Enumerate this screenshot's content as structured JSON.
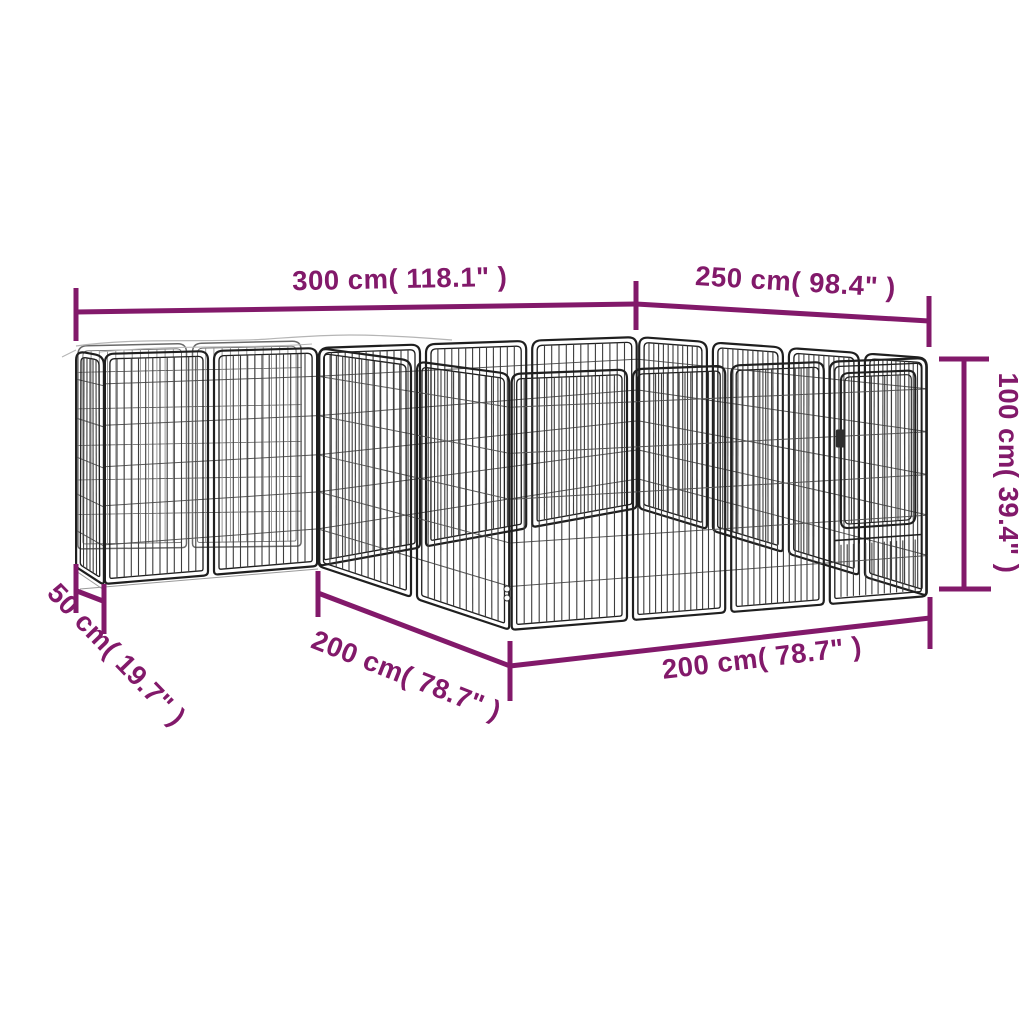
{
  "image_type": "product-dimension-diagram",
  "subject": "dog-playpen-wireframe-drawing",
  "colors": {
    "background": "#ffffff",
    "dimension_annotation": "#82196a",
    "pen_frame_dark": "#1f1f1f",
    "pen_frame_mid": "#2e2e2e",
    "pen_bar_near": "#3d3d3d",
    "pen_bar_far": "#8b8b8b",
    "pen_wire": "#5a5a5a",
    "pen_accent_light": "#b5b5b5"
  },
  "dimensions": {
    "top_left": {
      "label": "300 cm( 118.1\" )",
      "value_cm": 300,
      "value_in": 118.1
    },
    "top_right": {
      "label": "250 cm( 98.4\" )",
      "value_cm": 250,
      "value_in": 98.4
    },
    "right_height": {
      "label": "100 cm( 39.4\" )",
      "value_cm": 100,
      "value_in": 39.4
    },
    "left_depth": {
      "label": "50 cm( 19.7\" )",
      "value_cm": 50,
      "value_in": 19.7
    },
    "front_left_length": {
      "label": "200 cm( 78.7\" )",
      "value_cm": 200,
      "value_in": 78.7
    },
    "front_length": {
      "label": "200 cm( 78.7\" )",
      "value_cm": 200,
      "value_in": 78.7
    }
  }
}
